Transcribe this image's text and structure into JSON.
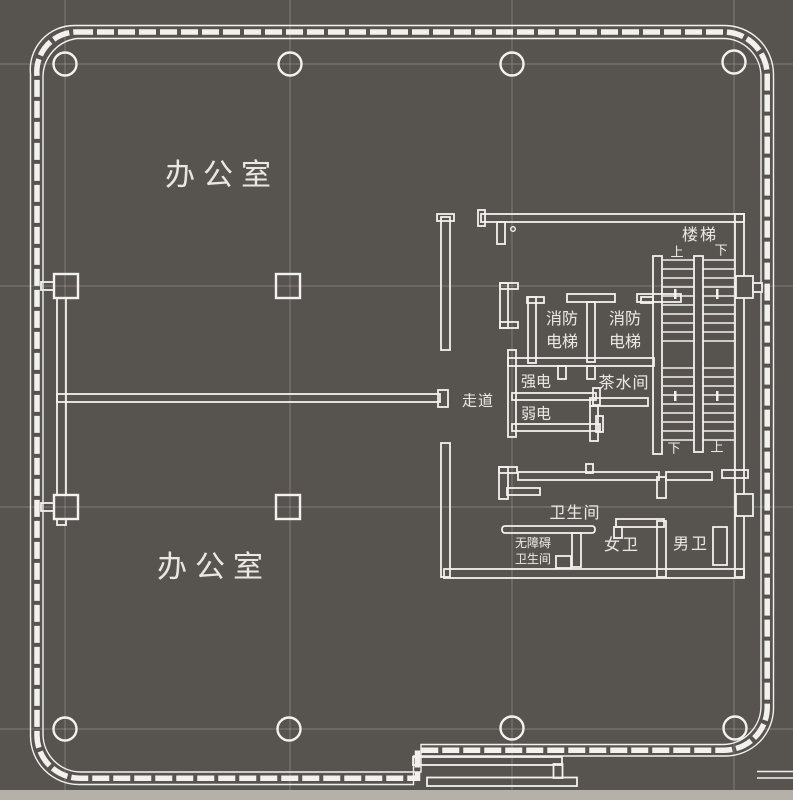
{
  "theme": {
    "bg": "#575450",
    "wall": "#f3f1ed",
    "grid": "rgba(255,255,255,0.24)",
    "label": "#e9e7e2",
    "strip": "#b5b0a8"
  },
  "plan": {
    "type": "architectural-floor-plan",
    "labels": {
      "office_top": "办公室",
      "office_bottom": "办公室",
      "stair": "楼梯",
      "stair_top_up": "上",
      "stair_top_down": "下",
      "stair_bottom_down": "下",
      "stair_bottom_up": "上",
      "fire_elevator_1_line1": "消防",
      "fire_elevator_1_line2": "电梯",
      "fire_elevator_2_line1": "消防",
      "fire_elevator_2_line2": "电梯",
      "strong_electric": "强电",
      "weak_electric": "弱电",
      "tea_room": "茶水间",
      "corridor": "走道",
      "restroom": "卫生间",
      "accessible_restroom_line1": "无障碍",
      "accessible_restroom_line2": "卫生间",
      "womens_restroom": "女卫",
      "mens_restroom": "男卫"
    }
  }
}
